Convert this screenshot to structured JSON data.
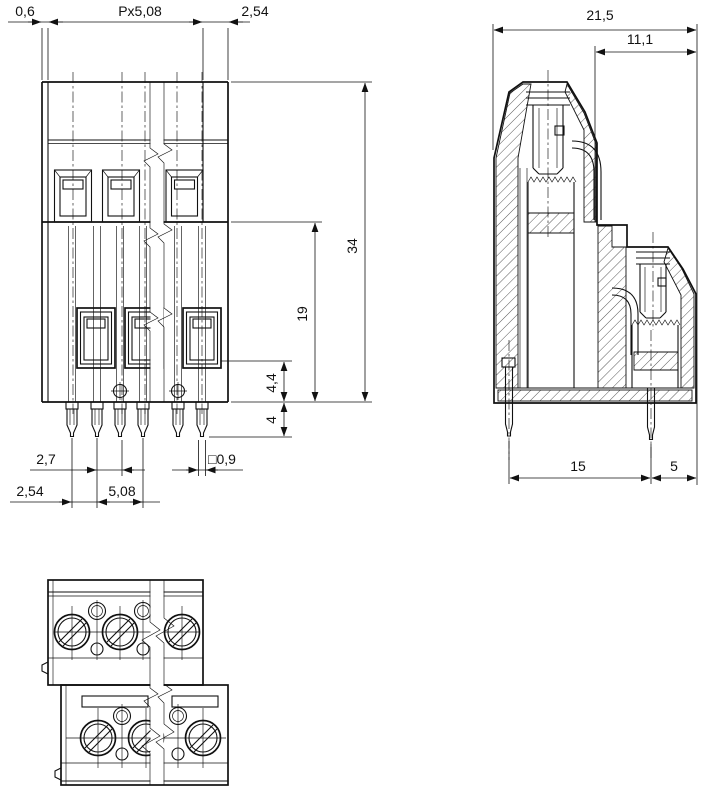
{
  "views": {
    "front": {
      "dims": {
        "wall_thickness": "0,6",
        "pole_pitch": "Px5,08",
        "level_offset": "2,54",
        "total_height": "34",
        "lower_height": "19",
        "clamp_height": "4,4",
        "pin_length": "4",
        "pin_gap": "2,7",
        "pin_offset": "2,54",
        "pin_pitch": "5,08",
        "pin_square": "□0,9"
      }
    },
    "side": {
      "dims": {
        "total_depth": "21,5",
        "front_level_depth": "11,1",
        "pin_row_spacing": "15",
        "pin_to_edge": "5"
      }
    }
  }
}
